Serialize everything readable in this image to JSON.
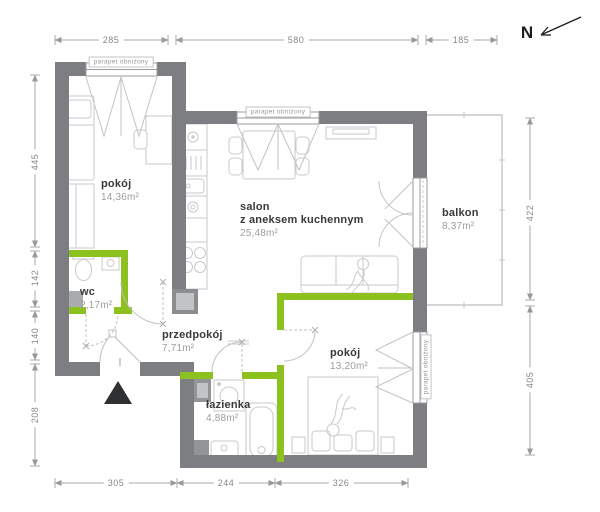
{
  "rooms": {
    "pokoj_nw": {
      "name": "pokój",
      "area": "14,36m²"
    },
    "salon": {
      "name": "salon",
      "subtitle": "z aneksem kuchennym",
      "area": "25,48m²"
    },
    "wc": {
      "name": "wc",
      "area": "2,17m²"
    },
    "przedpokoj": {
      "name": "przedpokój",
      "area": "7,71m²"
    },
    "lazienka": {
      "name": "łazienka",
      "area": "4,88m²"
    },
    "pokoj_se": {
      "name": "pokój",
      "area": "13,20m²"
    },
    "balkon": {
      "name": "balkon",
      "area": "8,37m²"
    }
  },
  "dimensions_cm": {
    "top": [
      "285",
      "580",
      "185"
    ],
    "left": [
      "445",
      "142",
      "140",
      "208"
    ],
    "right": [
      "422",
      "405"
    ],
    "bottom": [
      "305",
      "244",
      "326"
    ]
  },
  "labels": {
    "parapet": "parapet obniżony",
    "north": "N"
  },
  "colors": {
    "wall": "#7c7e81",
    "partition_wall": "#8cc11f",
    "furniture": "#c9cacc",
    "dimension": "#a8aaac"
  }
}
